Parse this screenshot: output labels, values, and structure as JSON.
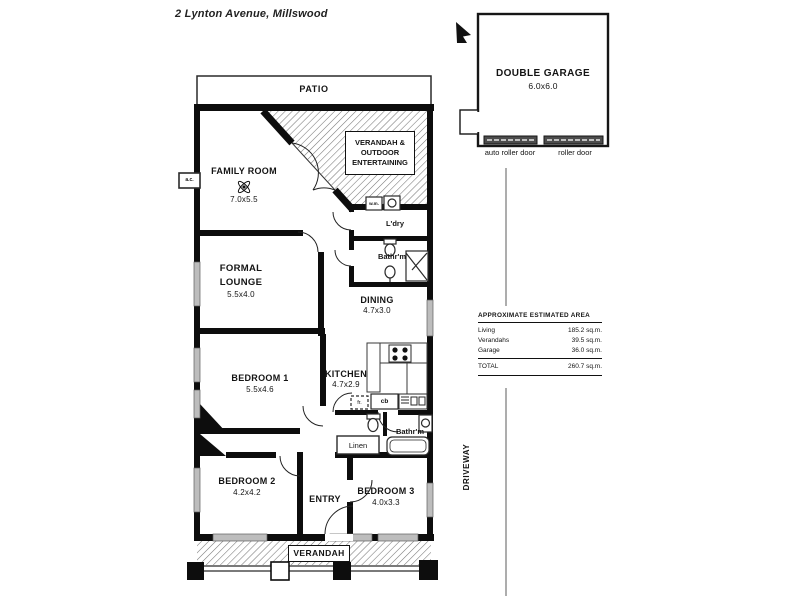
{
  "page": {
    "title": "2 Lynton Avenue, Millswood"
  },
  "rooms": {
    "patio": "PATIO",
    "verandah_outdoor": "VERANDAH & OUTDOOR ENTERTAINING",
    "family_room": {
      "name": "FAMILY ROOM",
      "size": "7.0x5.5"
    },
    "laundry": "L'dry",
    "bathroom1": "Bathr'm",
    "formal_lounge": {
      "name": "FORMAL LOUNGE",
      "size": "5.5x4.0"
    },
    "dining": {
      "name": "DINING",
      "size": "4.7x3.0"
    },
    "bedroom1": {
      "name": "BEDROOM 1",
      "size": "5.5x4.6"
    },
    "kitchen": {
      "name": "KITCHEN",
      "size": "4.7x2.9"
    },
    "bathroom2": "Bathr'm",
    "linen": "Linen",
    "bedroom2": {
      "name": "BEDROOM 2",
      "size": "4.2x4.2"
    },
    "entry": "ENTRY",
    "bedroom3": {
      "name": "BEDROOM 3",
      "size": "4.0x3.3"
    },
    "verandah_front": "VERANDAH",
    "driveway": "DRIVEWAY"
  },
  "garage": {
    "name": "DOUBLE GARAGE",
    "size": "6.0x6.0",
    "door1": "auto roller door",
    "door2": "roller door"
  },
  "fixtures": {
    "ac": "a.c.",
    "wm": "w.m.",
    "fridge": "fr.",
    "cb": "cb"
  },
  "area_table": {
    "title": "APPROXIMATE ESTIMATED AREA",
    "rows": [
      {
        "label": "Living",
        "value": "185.2 sq.m."
      },
      {
        "label": "Verandahs",
        "value": "39.5 sq.m."
      },
      {
        "label": "Garage",
        "value": "36.0 sq.m."
      }
    ],
    "total_label": "TOTAL",
    "total_value": "260.7 sq.m."
  }
}
